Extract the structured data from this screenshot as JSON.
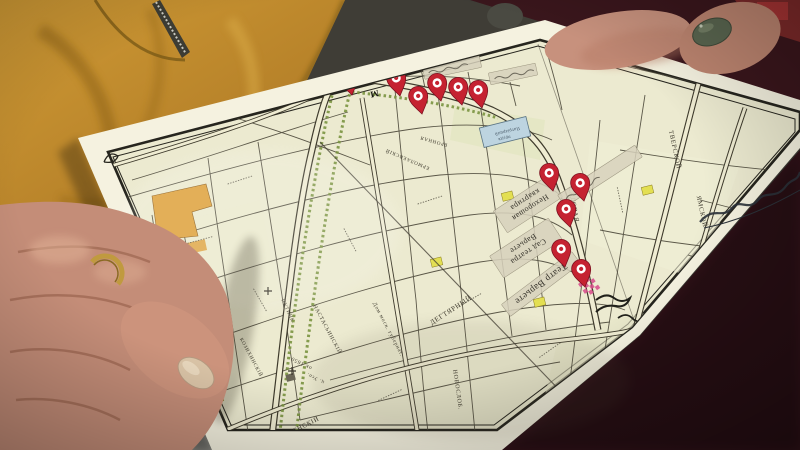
{
  "map": {
    "pond": {
      "line1": "Патріаршій",
      "line2": "прудъ"
    },
    "tape_labels": [
      {
        "text": "",
        "x": 452,
        "y": 67,
        "w": 58,
        "h": 13,
        "rot": -12
      },
      {
        "text": "",
        "x": 513,
        "y": 74,
        "w": 48,
        "h": 12,
        "rot": -12
      },
      {
        "text": "Нехорошая\nквартира",
        "x": 528,
        "y": 204,
        "w": 66,
        "h": 26,
        "rot": 147
      },
      {
        "text": "Сад театра\nВарьете",
        "x": 526,
        "y": 248,
        "w": 70,
        "h": 26,
        "rot": 147
      },
      {
        "text": "Театр Варьете",
        "x": 541,
        "y": 284,
        "w": 88,
        "h": 15,
        "rot": 143
      },
      {
        "text": "",
        "x": 600,
        "y": 176,
        "w": 92,
        "h": 14,
        "rot": -33
      }
    ],
    "street_labels": [
      {
        "text": "ТВЕРСКОЙ",
        "x": 673,
        "y": 150,
        "rot": 78,
        "size": 6.5
      },
      {
        "text": "ЯМСКОЙ",
        "x": 700,
        "y": 212,
        "rot": 78,
        "size": 6.5
      },
      {
        "text": "САДОВАЯ",
        "x": 572,
        "y": 205,
        "rot": 80,
        "size": 6.5
      },
      {
        "text": "ДЕГТЯРНЫЙ",
        "x": 452,
        "y": 312,
        "rot": -33,
        "size": 7
      },
      {
        "text": "НАСТАСЬИНСКІЙ",
        "x": 326,
        "y": 330,
        "rot": 62,
        "size": 5.5
      },
      {
        "text": "Дом моск. губернат.",
        "x": 387,
        "y": 330,
        "rot": 62,
        "size": 5.5
      },
      {
        "text": "ок.1650",
        "x": 302,
        "y": 362,
        "rot": 207,
        "size": 5.5
      },
      {
        "text": "ц. Усп.",
        "x": 316,
        "y": 377,
        "rot": 207,
        "size": 5
      },
      {
        "text": "УСПЕНСКІЙ",
        "x": 300,
        "y": 430,
        "rot": -27,
        "size": 6.5
      },
      {
        "text": "ЕРМОЛАЕВСКІЙ",
        "x": 408,
        "y": 158,
        "rot": 203,
        "size": 5
      },
      {
        "text": "БРОННАЯ",
        "x": 434,
        "y": 140,
        "rot": 196,
        "size": 5
      },
      {
        "text": "НОВОСЛОБ.",
        "x": 456,
        "y": 390,
        "rot": 82,
        "size": 6
      },
      {
        "text": "КОЗИХИНСКІЙ",
        "x": 250,
        "y": 358,
        "rot": 62,
        "size": 5
      },
      {
        "text": "ПУТИНК.",
        "x": 287,
        "y": 312,
        "rot": 65,
        "size": 5
      }
    ],
    "metro_marks": [
      {
        "glyph": "М",
        "x": 374,
        "y": 91,
        "rot": 168
      },
      {
        "glyph": "М",
        "x": 547,
        "y": 172,
        "rot": 168
      }
    ],
    "pins": [
      {
        "x": 352,
        "y": 95
      },
      {
        "x": 400,
        "y": 96
      },
      {
        "x": 422,
        "y": 114
      },
      {
        "x": 441,
        "y": 101
      },
      {
        "x": 462,
        "y": 105
      },
      {
        "x": 482,
        "y": 108
      },
      {
        "x": 553,
        "y": 191
      },
      {
        "x": 584,
        "y": 201
      },
      {
        "x": 570,
        "y": 227
      },
      {
        "x": 565,
        "y": 267
      },
      {
        "x": 585,
        "y": 287
      }
    ],
    "colors": {
      "pin_red": "#c52231",
      "tape": "#d8d2bd",
      "pond_blue": "#bdd4e0",
      "paper": "#f5f2e0",
      "map_background": "#ecead0",
      "jacket_yellow": "#c08a2c",
      "nail_polish": "#5a6650",
      "marker_pink": "#d84a8a",
      "block_yellow": "#e3df52",
      "block_orange": "#dfa23c",
      "clothing_maroon": "#3a161c",
      "skin": "#c48d78"
    }
  }
}
